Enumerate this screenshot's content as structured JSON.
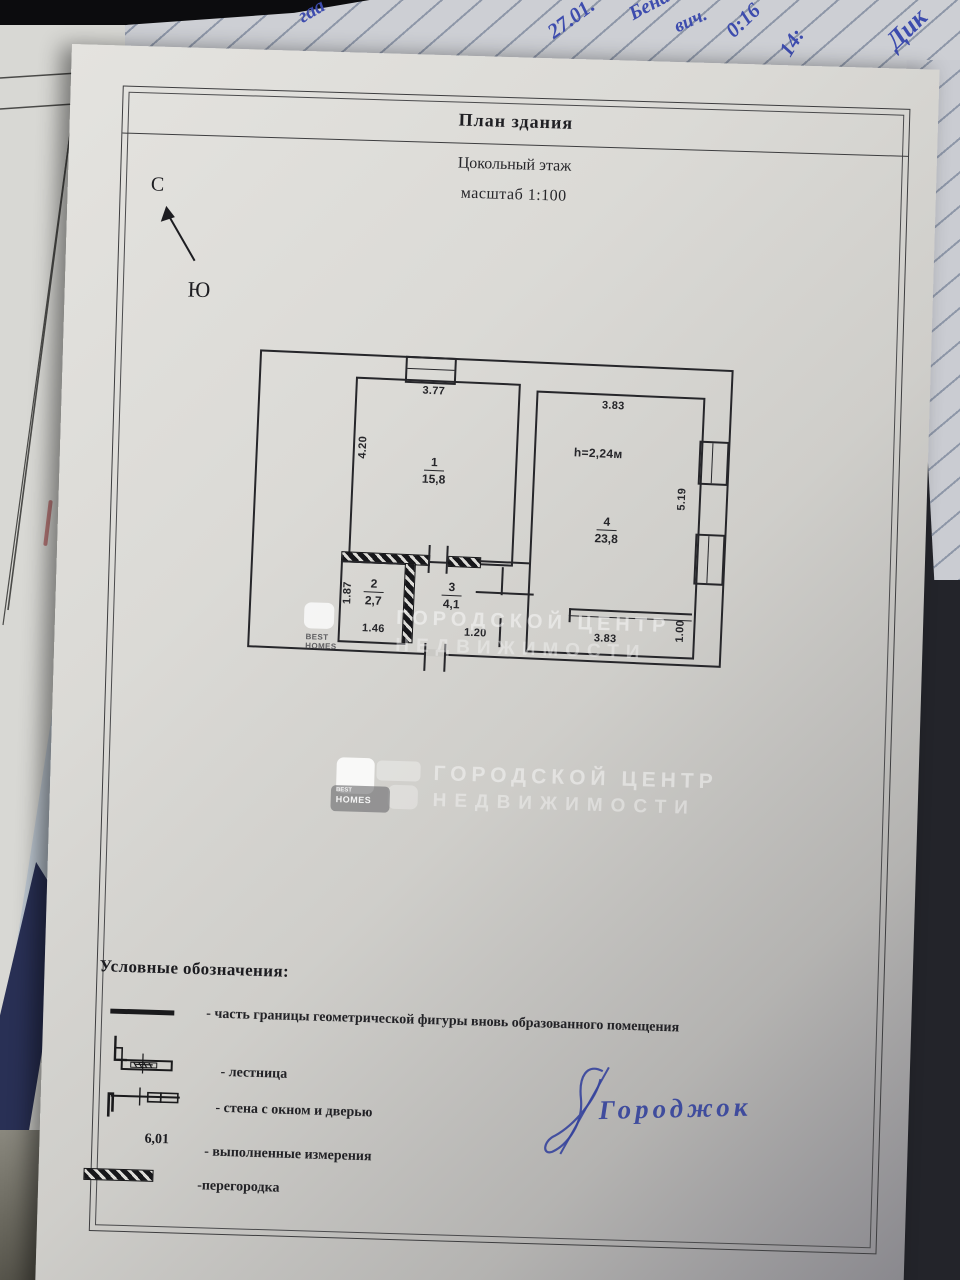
{
  "photo": {
    "handwriting_fragments": [
      {
        "text": "гаа"
      },
      {
        "text": "дм"
      },
      {
        "text": "27.01."
      },
      {
        "text": "Бена"
      },
      {
        "text": "вич."
      },
      {
        "text": "0:16"
      },
      {
        "text": "14:"
      },
      {
        "text": "Дик"
      },
      {
        "text": "(01"
      }
    ]
  },
  "document": {
    "title": "План здания",
    "floor": "Цокольный этаж",
    "scale": "масштаб 1:100",
    "compass": {
      "north": "С",
      "south": "Ю"
    },
    "plan": {
      "room1": {
        "num": "1",
        "area": "15,8",
        "dim_top": "3.77",
        "dim_left": "4.20"
      },
      "room2": {
        "num": "2",
        "area": "2,7",
        "dim_left": "1.87",
        "dim_bottom": "1.46"
      },
      "room3": {
        "num": "3",
        "area": "4,1",
        "dim_bottom": "1.20"
      },
      "room4": {
        "num": "4",
        "area": "23,8",
        "dim_top": "3.83",
        "dim_right": "5.19",
        "ceiling": "h=2,24м",
        "dim_bottom": "3.83",
        "dim_landing": "1.00"
      }
    },
    "watermark": {
      "brand_line1": "BEST",
      "brand_line2": "HOMES",
      "text_line1": "ГОРОДСКОЙ ЦЕНТР",
      "text_line2": "НЕДВИЖИМОСТИ"
    },
    "legend": {
      "title": "Условные обозначения:",
      "items": [
        {
          "label": "- часть границы геометрической фигуры вновь образованного помещения"
        },
        {
          "label": "- лестница"
        },
        {
          "label": "- стена с окном и дверью"
        },
        {
          "label": "- выполненные измерения",
          "value": "6,01"
        },
        {
          "label": "-перегородка"
        }
      ]
    },
    "signature": {
      "text": "Городжок"
    }
  }
}
